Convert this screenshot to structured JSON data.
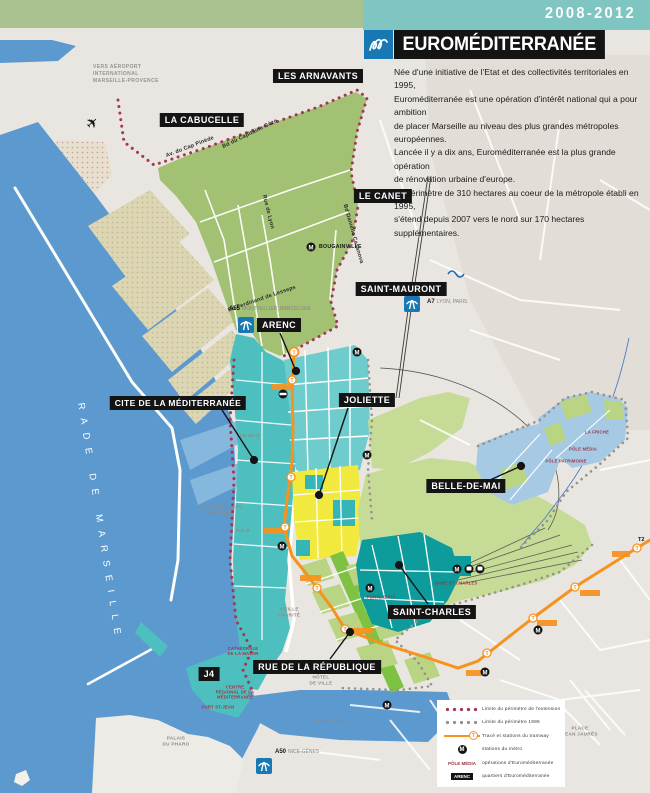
{
  "header": {
    "period": "2008-2012",
    "title": "EUROMÉDITERRANÉE"
  },
  "intro": {
    "text": "Née d'une initiative de l'Etat et des collectivités territoriales en 1995,\nEuroméditerranée est une opération d'intérêt national qui a pour ambition\nde placer Marseille au niveau des plus grandes métropoles européennes.\nLancée il y a dix ans, Euroméditerranée est la plus grande opération\nde rénovation urbaine d'europe.\nLe périmètre de 310 hectares au coeur de la métropole établi en 1995,\ns'étend depuis 2007 vers le nord sur 170 hectares supplémentaires."
  },
  "map": {
    "sea_label": "RADE DE MARSEILLE",
    "airport_note": "VERS AÉROPORT\nINTERNATIONAL\nMARSEILLE-PROVENCE",
    "districts": [
      {
        "id": "les-arnavants",
        "label": "LES ARNAVANTS"
      },
      {
        "id": "la-cabucelle",
        "label": "LA CABUCELLE"
      },
      {
        "id": "le-canet",
        "label": "LE CANET"
      },
      {
        "id": "saint-mauront",
        "label": "SAINT-MAURONT"
      },
      {
        "id": "arenc",
        "label": "ARENC"
      },
      {
        "id": "cite-de-la-mediterranee",
        "label": "CITE DE LA MÉDITERRANÉE"
      },
      {
        "id": "joliette",
        "label": "JOLIETTE"
      },
      {
        "id": "belle-de-mai",
        "label": "BELLE-DE-MAI"
      },
      {
        "id": "saint-charles",
        "label": "SAINT-CHARLES"
      },
      {
        "id": "rue-de-la-republique",
        "label": "RUE DE LA RÉPUBLIQUE"
      },
      {
        "id": "j4",
        "label": "J4"
      }
    ],
    "roads": [
      {
        "label": "Bd du Capitaine Gèze"
      },
      {
        "label": "Av. du Cap Pinède"
      },
      {
        "label": "Bd Ferdinand de Lesseps"
      },
      {
        "label": "Bd Danielle Casanova"
      },
      {
        "label": "Rue de Lyon"
      }
    ],
    "highways": [
      {
        "code": "A55",
        "destinations": "MONTPELLIER, BARCELONE"
      },
      {
        "code": "A7",
        "destinations": "LYON, PARIS"
      },
      {
        "code": "A50",
        "destinations": "NICE-GÊNES"
      }
    ],
    "metro_station": "BOUGAINVILLE",
    "tram_line_label": "T2",
    "operations": [
      {
        "label": "LA FRICHE"
      },
      {
        "label": "PÔLE MÉDIA"
      },
      {
        "label": "PÔLE PATRIMOINE"
      },
      {
        "label": "GARE ST CHARLES"
      },
      {
        "label": "PORTE D'AIX"
      },
      {
        "label": "CATHÉDRALE\nDE LA MAJOR"
      },
      {
        "label": "CENTRE\nRÉGIONAL DE LA\nMÉDITERRANÉE"
      },
      {
        "label": "FORT ST-JEAN"
      }
    ],
    "places": [
      {
        "label": "VIEUX-PORT"
      },
      {
        "label": "P.A.M"
      },
      {
        "label": "LE SILO"
      },
      {
        "label": "LES TERRASSES\nDU PORT"
      },
      {
        "label": "PALAIS\nDU PHARO"
      },
      {
        "label": "PLACE\nJEAN JAURÈS"
      },
      {
        "label": "VIEILLE\nCHARITÉ"
      },
      {
        "label": "HÔTEL\nDE VILLE"
      }
    ]
  },
  "legend": {
    "rows": [
      {
        "label": "Limite du périmètre de l'extension"
      },
      {
        "label": "Limite du périmètre 1995"
      },
      {
        "label": "Tracé et stations du tramway"
      },
      {
        "label": "stations du métro"
      },
      {
        "label": "opérations d'Euroméditerranée",
        "sample": "PÔLE MÉDIA"
      },
      {
        "label": "quartiers d'Euroméditerranée",
        "sample": "ARENC"
      }
    ]
  },
  "icons": {
    "metro": "M",
    "tram": "T",
    "plane": "✈"
  },
  "colors": {
    "band_green": "#a9c28f",
    "band_teal": "#7fc6c2",
    "logo_blue": "#1878b4",
    "banner_black": "#141414",
    "sea": "#5b99cf",
    "waterfront_teal": "#4dbfbf",
    "blocks_teal": "#6fcccc",
    "dark_teal": "#0d9b9b",
    "yellow": "#f2e93e",
    "green_medium": "#7dc242",
    "green_light": "#c6dc96",
    "olive": "#a2c172",
    "belle_blue": "#a6c9e4",
    "tram_orange": "#f6921e",
    "perimeter_red": "#a03a50",
    "perimeter_gray": "#97928b",
    "dock_beige": "#ddd6b4"
  }
}
